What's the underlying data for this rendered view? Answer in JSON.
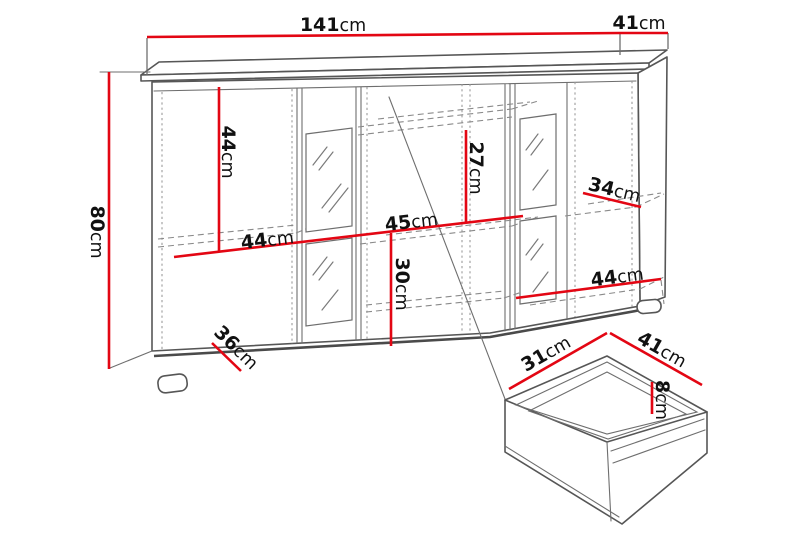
{
  "diagram": {
    "type": "furniture-dimension-drawing",
    "subject": "sideboard with glass doors and detail view of drawer",
    "unit": "cm",
    "colors": {
      "dimension_line": "#e30613",
      "outline": "#565656",
      "dashed_line": "#8a8a8a",
      "text": "#111111",
      "background": "#ffffff"
    },
    "dimensions": {
      "width": {
        "value": "141",
        "unit": "cm"
      },
      "depth": {
        "value": "41",
        "unit": "cm"
      },
      "height": {
        "value": "80",
        "unit": "cm"
      },
      "left_column_height": {
        "value": "44",
        "unit": "cm"
      },
      "left_section_width": {
        "value": "44",
        "unit": "cm"
      },
      "middle_section_width": {
        "value": "45",
        "unit": "cm"
      },
      "middle_upper_height": {
        "value": "27",
        "unit": "cm"
      },
      "middle_lower_height": {
        "value": "30",
        "unit": "cm"
      },
      "right_shelf_depth": {
        "value": "34",
        "unit": "cm"
      },
      "right_section_width": {
        "value": "44",
        "unit": "cm"
      },
      "base_depth": {
        "value": "36",
        "unit": "cm"
      },
      "drawer_depth": {
        "value": "31",
        "unit": "cm"
      },
      "drawer_width": {
        "value": "41",
        "unit": "cm"
      },
      "drawer_front_height": {
        "value": "8",
        "unit": "cm"
      }
    }
  }
}
